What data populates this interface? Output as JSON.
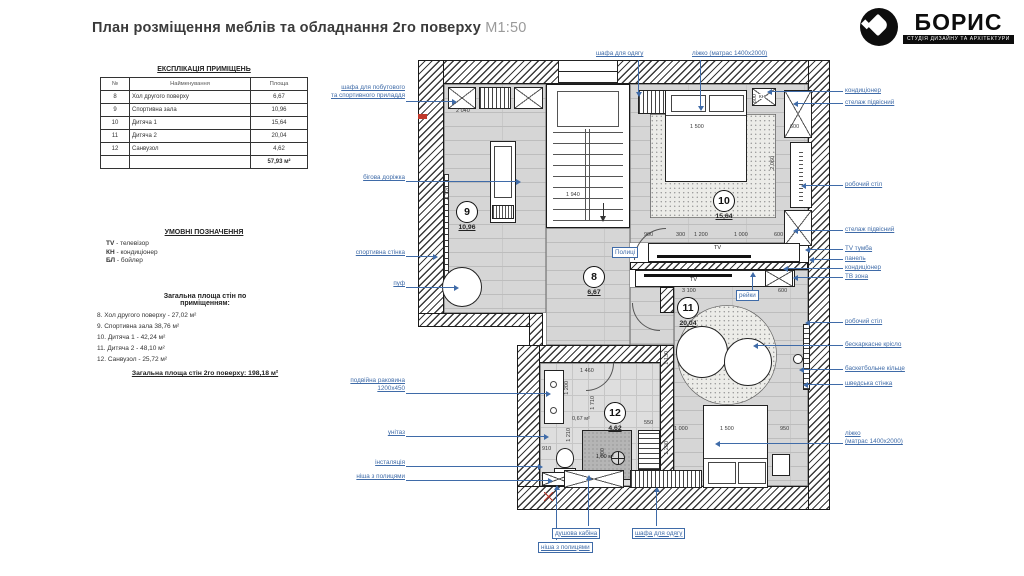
{
  "title": {
    "main": "План розміщення меблів та обладнання 2го поверху",
    "scale": "М1:50"
  },
  "logo": {
    "name": "БОРИС",
    "subtitle": "СТУДІЯ ДИЗАЙНУ ТА АРХІТЕКТУРИ"
  },
  "explication": {
    "title": "ЕКСПЛІКАЦІЯ ПРИМІЩЕНЬ",
    "headers": {
      "num": "№",
      "name": "Найменування",
      "area": "Площа"
    },
    "rows": [
      {
        "num": "8",
        "name": "Хол другого поверху",
        "area": "6,67"
      },
      {
        "num": "9",
        "name": "Спортивна зала",
        "area": "10,96"
      },
      {
        "num": "10",
        "name": "Дитяча 1",
        "area": "15,64"
      },
      {
        "num": "11",
        "name": "Дитяча 2",
        "area": "20,04"
      },
      {
        "num": "12",
        "name": "Санвузол",
        "area": "4,62"
      }
    ],
    "total": "57,93 м²"
  },
  "legend": {
    "title": "УМОВНІ ПОЗНАЧЕННЯ",
    "items": [
      {
        "abbr": "TV",
        "desc": " - телевізор"
      },
      {
        "abbr": "КН",
        "desc": " - кондиціонер"
      },
      {
        "abbr": "БЛ",
        "desc": " - бойлер"
      }
    ]
  },
  "wall_areas": {
    "title": "Загальна площа стін по\nприміщенням:",
    "items": [
      "8. Хол другого поверху - 27,02 м²",
      "9. Спортивна зала 38,76 м²",
      "10. Дитяча 1 - 42,24 м²",
      "11. Дитяча 2 - 48,10 м²",
      "12. Санвузол - 25,72 м²"
    ],
    "total": "Загальна площа стін 2го поверху: 198,18 м²"
  },
  "rooms": [
    {
      "num": "9",
      "area": "10,96"
    },
    {
      "num": "10",
      "area": "15,64"
    },
    {
      "num": "8",
      "area": "6,67"
    },
    {
      "num": "11",
      "area": "20,04"
    },
    {
      "num": "12",
      "area": "4,62"
    }
  ],
  "annotations": {
    "left": [
      "шафа для побутового\nта спортивного приладдя",
      "бігова доріжка",
      "спортивна стінка",
      "пуф",
      "подвійна раковина\n1200х450",
      "унітаз",
      "інсталяція",
      "ніша з полицями"
    ],
    "top": [
      "шафа для одягу",
      "ліжко (матрас 1400х2000)"
    ],
    "right": [
      "кондиціонер",
      "стелаж підвісний",
      "робочий стіл",
      "стелаж підвісний",
      "TV тумба",
      "панель",
      "кондиціонер",
      "ТВ зона",
      "робочий стіл",
      "бескаркасне крісло",
      "баскетбольне кільце",
      "шведська стінка",
      "ліжко\n(матрас 1400х2000)"
    ],
    "bottom": [
      "душова кабіна",
      "ніша з полицями",
      "шафа для одягу"
    ],
    "inner": {
      "shelves": "Полиці",
      "rails": "рейки",
      "tv": "TV",
      "kn": "КН"
    }
  },
  "dims": [
    "2 040",
    "4 720",
    "1 940",
    "1 500",
    "600",
    "800",
    "2 060",
    "900",
    "300",
    "1 200",
    "1 000",
    "600",
    "3 100",
    "600",
    "1 000",
    "1 500",
    "950",
    "1 130",
    "1 200",
    "1 460",
    "1 200",
    "1 710",
    "1 210",
    "910",
    "700",
    "550",
    "0,67 м²",
    "1,00 м²"
  ],
  "colors": {
    "annotation": "#3f6ba8",
    "wall": "#3a3a3a",
    "floor": "#d6d6d6",
    "accent_red": "#c0392b"
  }
}
